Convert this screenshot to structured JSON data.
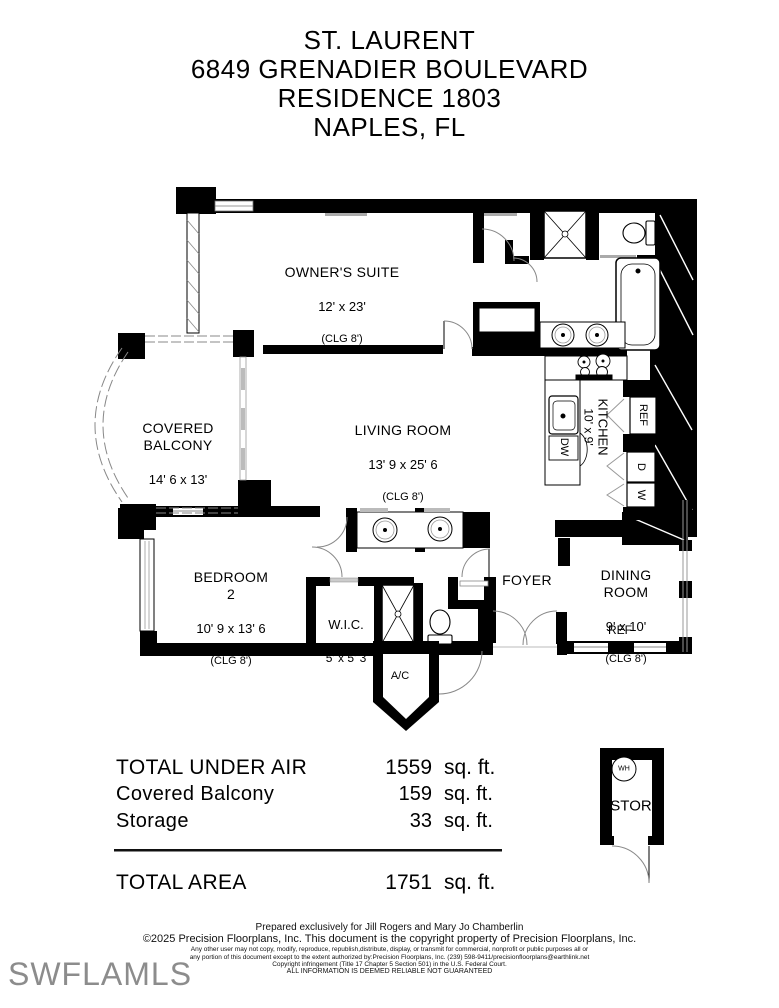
{
  "header": {
    "line1": "ST. LAURENT",
    "line2": "6849 GRENADIER BOULEVARD",
    "line3": "RESIDENCE 1803",
    "line4": "NAPLES, FL"
  },
  "rooms": {
    "owners_suite": {
      "name": "OWNER'S SUITE",
      "dims": "12' x 23'",
      "clg": "(CLG 8')"
    },
    "living_room": {
      "name": "LIVING ROOM",
      "dims": "13' 9 x 25' 6",
      "clg": "(CLG 8')"
    },
    "covered_balcony": {
      "name": "COVERED\nBALCONY",
      "dims": "14' 6 x 13'"
    },
    "bedroom2": {
      "name": "BEDROOM\n2",
      "dims": "10' 9 x 13' 6",
      "clg": "(CLG 8')"
    },
    "wic": {
      "name": "W.I.C.",
      "dims": "5' x 5' 3"
    },
    "foyer": {
      "name": "FOYER"
    },
    "dining_room": {
      "name": "DINING\nROOM",
      "dims": "9' x 10'",
      "clg": "(CLG 8')"
    },
    "kitchen": {
      "name": "KITCHEN",
      "dims": "10' x 9'"
    },
    "ac_closet": {
      "name": "A/C"
    },
    "storage": {
      "name": "STOR",
      "water_heater": "WH"
    }
  },
  "appliances": {
    "ref_kitchen": "REF",
    "ref_dining": "REF",
    "dishwasher": "DW",
    "dryer": "D",
    "washer": "W"
  },
  "totals": {
    "rows": [
      {
        "label": "TOTAL UNDER AIR",
        "value": "1559",
        "unit": "sq. ft."
      },
      {
        "label": "Covered Balcony",
        "value": "159",
        "unit": "sq. ft."
      },
      {
        "label": "Storage",
        "value": "33",
        "unit": "sq. ft."
      }
    ],
    "total": {
      "label": "TOTAL AREA",
      "value": "1751",
      "unit": "sq. ft."
    }
  },
  "footer": {
    "line1": "Prepared exclusively for Jill Rogers and Mary Jo Chamberlin",
    "line2": "©2025 Precision Floorplans, Inc.  This document is the copyright property of Precision Floorplans, Inc.",
    "line3": "Any other user may not copy, modify, reproduce, republish,distribute, display, or transmit for commercial, nonprofit or public purposes all or",
    "line4": "any portion of this document except to the extent authorized by:Precision Floorplans, Inc. (239) 598-9411/precisionfloorplans@earthlink.net",
    "line5": "Copyright infringement (Title 17 Chapter 5 Section 501) in the U.S. Federal Court.",
    "line6": "ALL INFORMATION IS DEEMED RELIABLE NOT GUARANTEED"
  },
  "watermark": "SWFLAMLS"
}
